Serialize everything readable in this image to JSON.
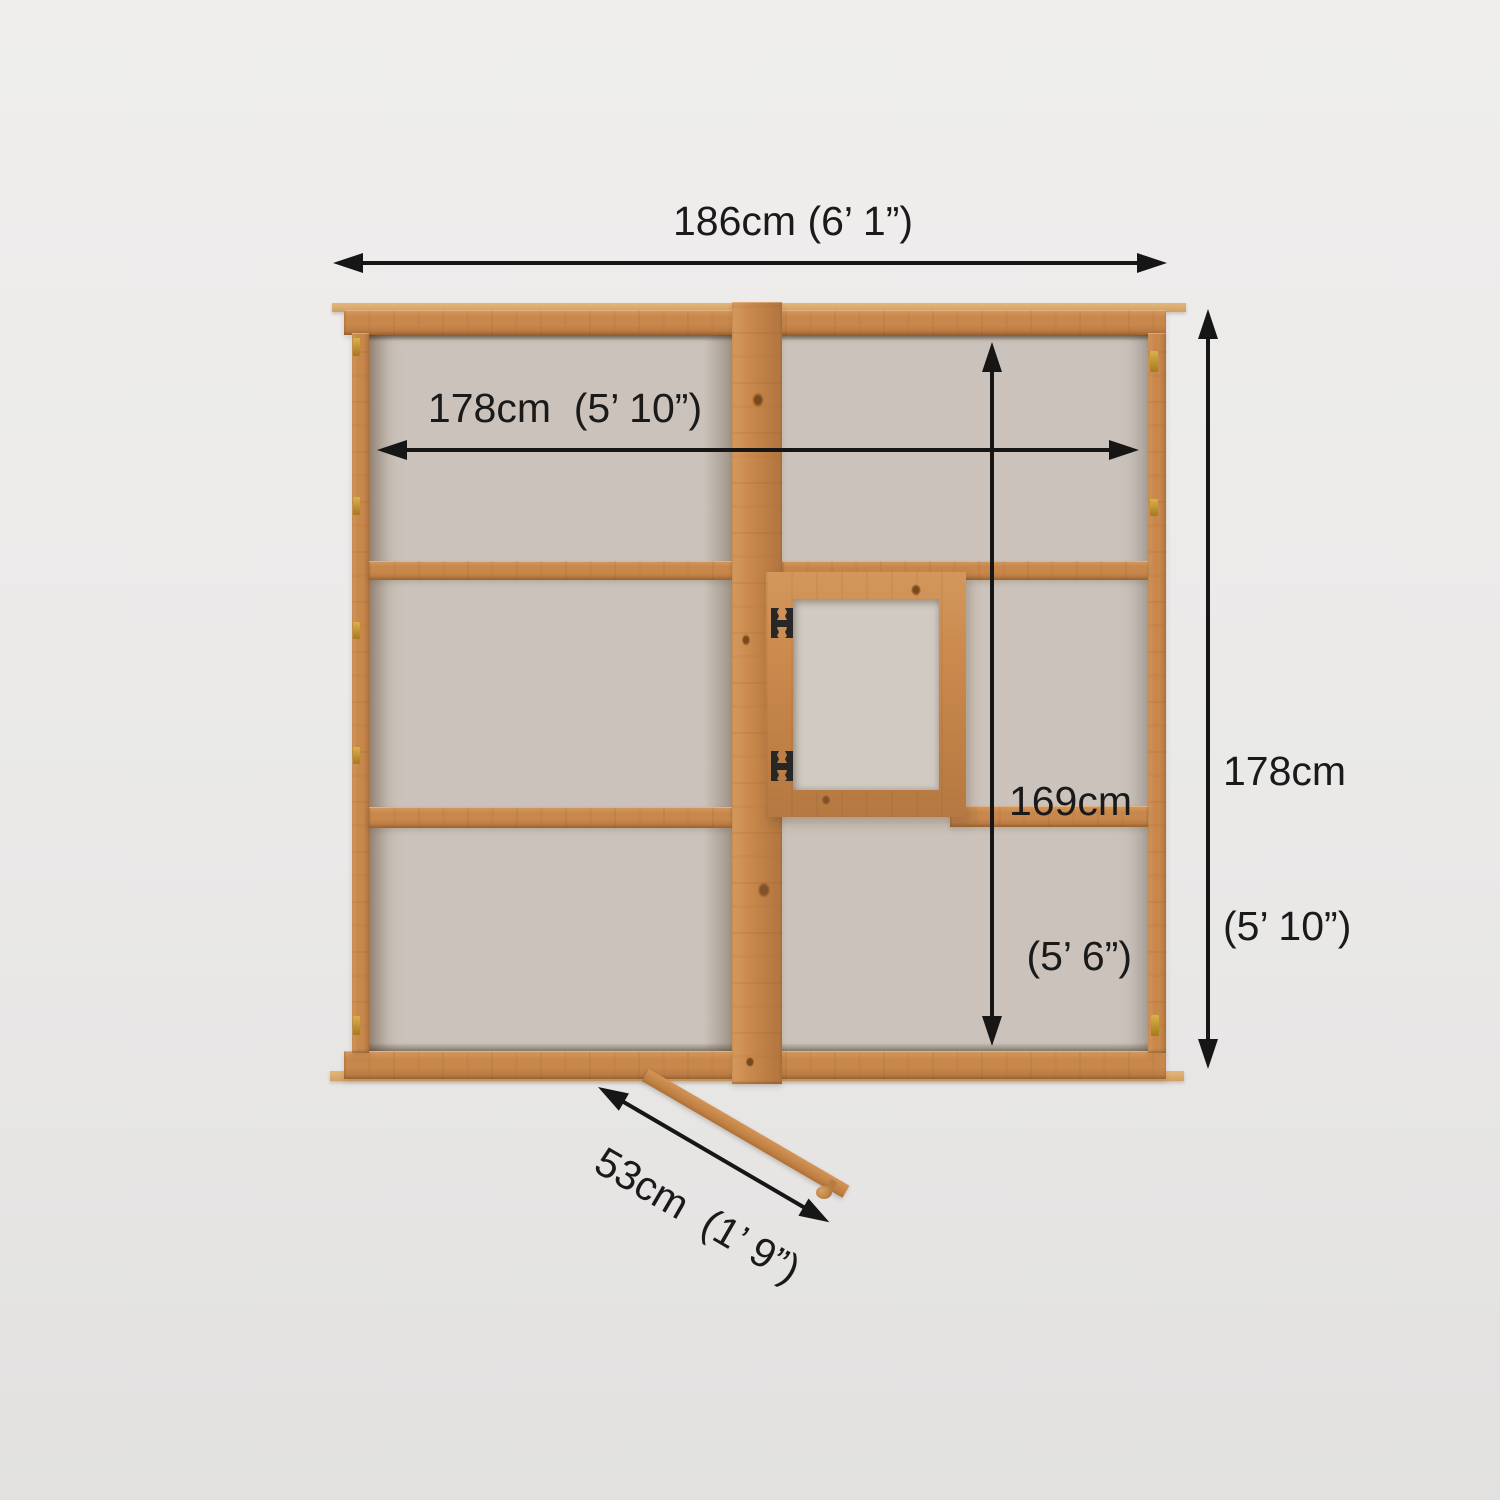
{
  "diagram": {
    "subject": "wooden greenhouse top-view dimension diagram",
    "dimensions": {
      "outer_width": "186cm (6’ 1”)",
      "inner_width": "178cm  (5’ 10”)",
      "depth_metric": "178cm",
      "depth_imperial": "(5’ 10”)",
      "inner_depth_metric": "169cm",
      "inner_depth_imperial": "(5’ 6”)",
      "door_width": "53cm  (1’ 9”)"
    },
    "colors": {
      "background": "#eae9e8",
      "wood": "#c8874b",
      "wood_light_edge": "#e2b77c",
      "glass": "#cbc3bb",
      "window_glass": "#d1cac3",
      "arrow_and_text": "#161616",
      "hinge_black": "#272727",
      "hinge_gold": "#c39b30"
    }
  }
}
